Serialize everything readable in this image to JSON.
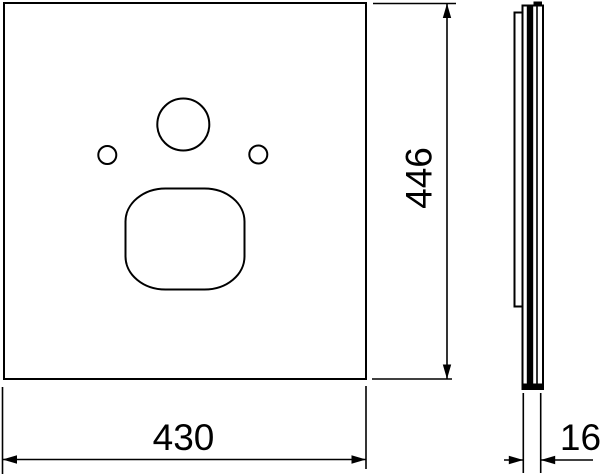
{
  "drawing": {
    "type": "technical-dimension-drawing",
    "background_color": "#ffffff",
    "line_color": "#000000",
    "dimensions": {
      "width": "430",
      "height": "446",
      "depth": "16"
    }
  }
}
